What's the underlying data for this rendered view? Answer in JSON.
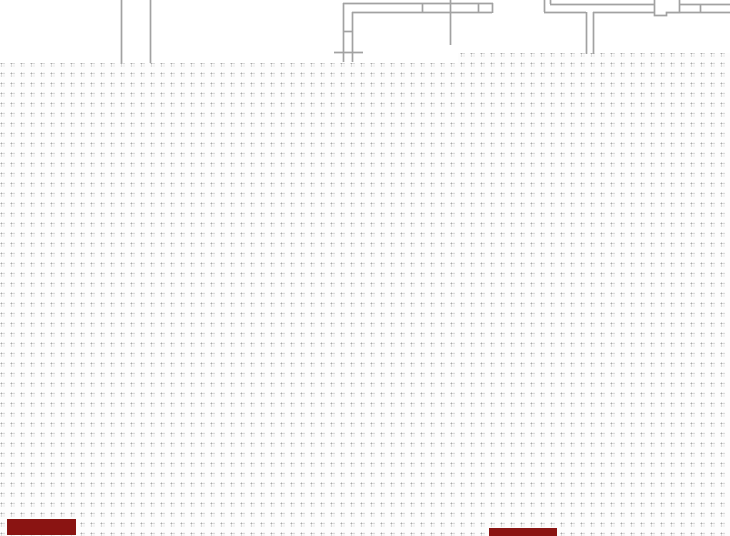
{
  "app": {
    "description": "CAD drawing canvas showing a dotted snap grid with two overlapping white drawing sheets at the top containing partial floor-plan wall linework",
    "colors": {
      "canvas_bg": "#fdfdfd",
      "panel_bg": "#ffffff",
      "wall_line": "#a2a2a2",
      "dot_primary": "#a8a8a8",
      "dot_secondary": "#d2d2d2",
      "dot_tertiary": "#e6e6e6",
      "mask": "#8a1412"
    }
  },
  "canvas": {
    "width": 730,
    "height": 536,
    "grid_spacing_px": 10
  },
  "sheets": [
    {
      "name": "left-sheet",
      "x": 0,
      "y": 0,
      "w": 458,
      "h": 63
    },
    {
      "name": "right-sheet",
      "x": 458,
      "y": 0,
      "w": 272,
      "h": 53
    }
  ],
  "walls": {
    "stroke_width": 1.7,
    "segments": [
      {
        "x1": 121.5,
        "y1": 0,
        "x2": 121.5,
        "y2": 63
      },
      {
        "x1": 150.5,
        "y1": 0,
        "x2": 150.5,
        "y2": 63
      },
      {
        "x1": 343,
        "y1": 3.5,
        "x2": 493,
        "y2": 3.5
      },
      {
        "x1": 352,
        "y1": 12.5,
        "x2": 492,
        "y2": 12.5
      },
      {
        "x1": 492.5,
        "y1": 3,
        "x2": 492.5,
        "y2": 13
      },
      {
        "x1": 343.5,
        "y1": 3,
        "x2": 343.5,
        "y2": 62
      },
      {
        "x1": 352.5,
        "y1": 12,
        "x2": 352.5,
        "y2": 62
      },
      {
        "x1": 343,
        "y1": 31.5,
        "x2": 353,
        "y2": 31.5
      },
      {
        "x1": 334,
        "y1": 52.5,
        "x2": 363,
        "y2": 52.5
      },
      {
        "x1": 422.5,
        "y1": 3,
        "x2": 422.5,
        "y2": 13
      },
      {
        "x1": 450.5,
        "y1": 0,
        "x2": 450.5,
        "y2": 45
      },
      {
        "x1": 478.5,
        "y1": 3,
        "x2": 478.5,
        "y2": 13
      },
      {
        "x1": 544.5,
        "y1": 0,
        "x2": 544.5,
        "y2": 12
      },
      {
        "x1": 550.5,
        "y1": 0,
        "x2": 550.5,
        "y2": 4
      },
      {
        "x1": 550,
        "y1": 4.5,
        "x2": 730,
        "y2": 4.5
      },
      {
        "x1": 544,
        "y1": 12.5,
        "x2": 586,
        "y2": 12.5
      },
      {
        "x1": 593,
        "y1": 12.5,
        "x2": 730,
        "y2": 12.5
      },
      {
        "x1": 586.5,
        "y1": 12,
        "x2": 586.5,
        "y2": 54
      },
      {
        "x1": 593.5,
        "y1": 12,
        "x2": 593.5,
        "y2": 54
      },
      {
        "x1": 700.5,
        "y1": 4,
        "x2": 700.5,
        "y2": 13
      }
    ],
    "notched_block_path": "M654.5,0 L654.5,15.5 L666.5,15.5 L666.5,12.5 L679.5,12.5 L679.5,0"
  },
  "masks": [
    {
      "name": "mask-bar-left",
      "x": 7,
      "y": 519,
      "w": 69,
      "h": 16
    },
    {
      "name": "mask-bar-center",
      "x": 489,
      "y": 528,
      "w": 68,
      "h": 8
    }
  ]
}
